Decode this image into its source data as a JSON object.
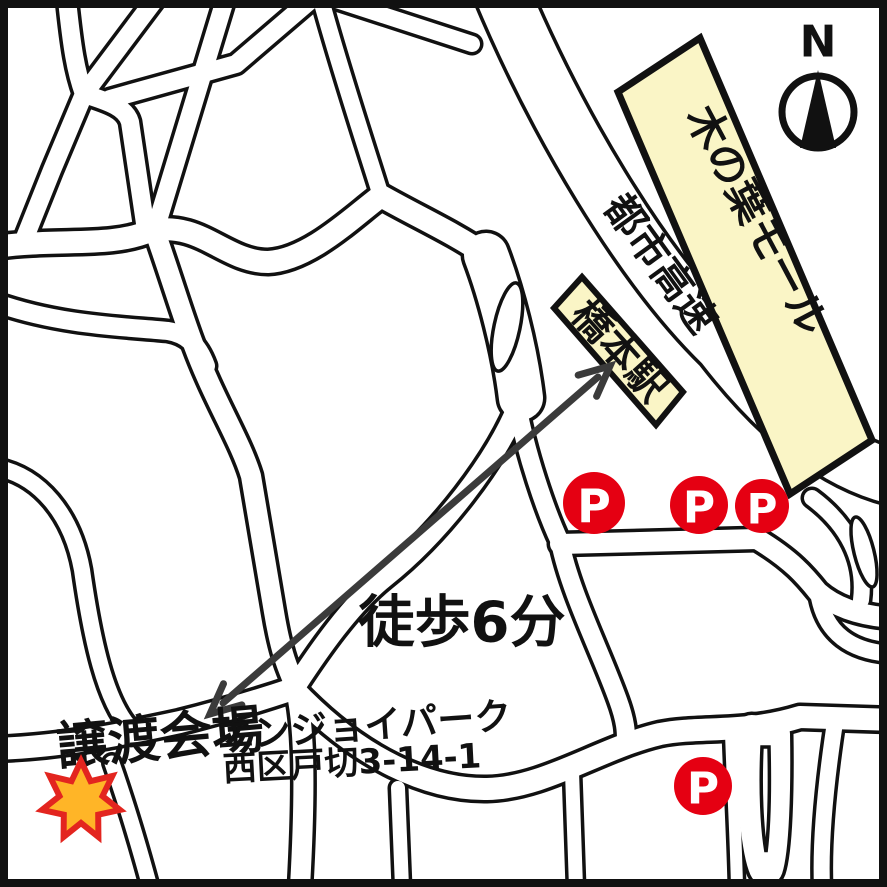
{
  "map": {
    "kind": "hand-drawn access map",
    "venue": {
      "name": "譲渡会場",
      "facility": "エンジョイパーク",
      "address": "西区戸切3-14-1"
    },
    "walk": {
      "label": "徒歩6分"
    },
    "station": {
      "name": "橋本駅"
    },
    "expressway": {
      "name": "都市高速"
    },
    "mall": {
      "name": "木の葉モール"
    },
    "compass": {
      "north_label": "N"
    },
    "parking": {
      "label": "P",
      "count": 4
    },
    "colors": {
      "accent_red": "#e50012",
      "building_cream": "#faf5c6",
      "star_fill": "#ffb527",
      "star_outline": "#e3251f",
      "arrow_gray": "#3b3b3b",
      "line_black": "#111111"
    }
  }
}
